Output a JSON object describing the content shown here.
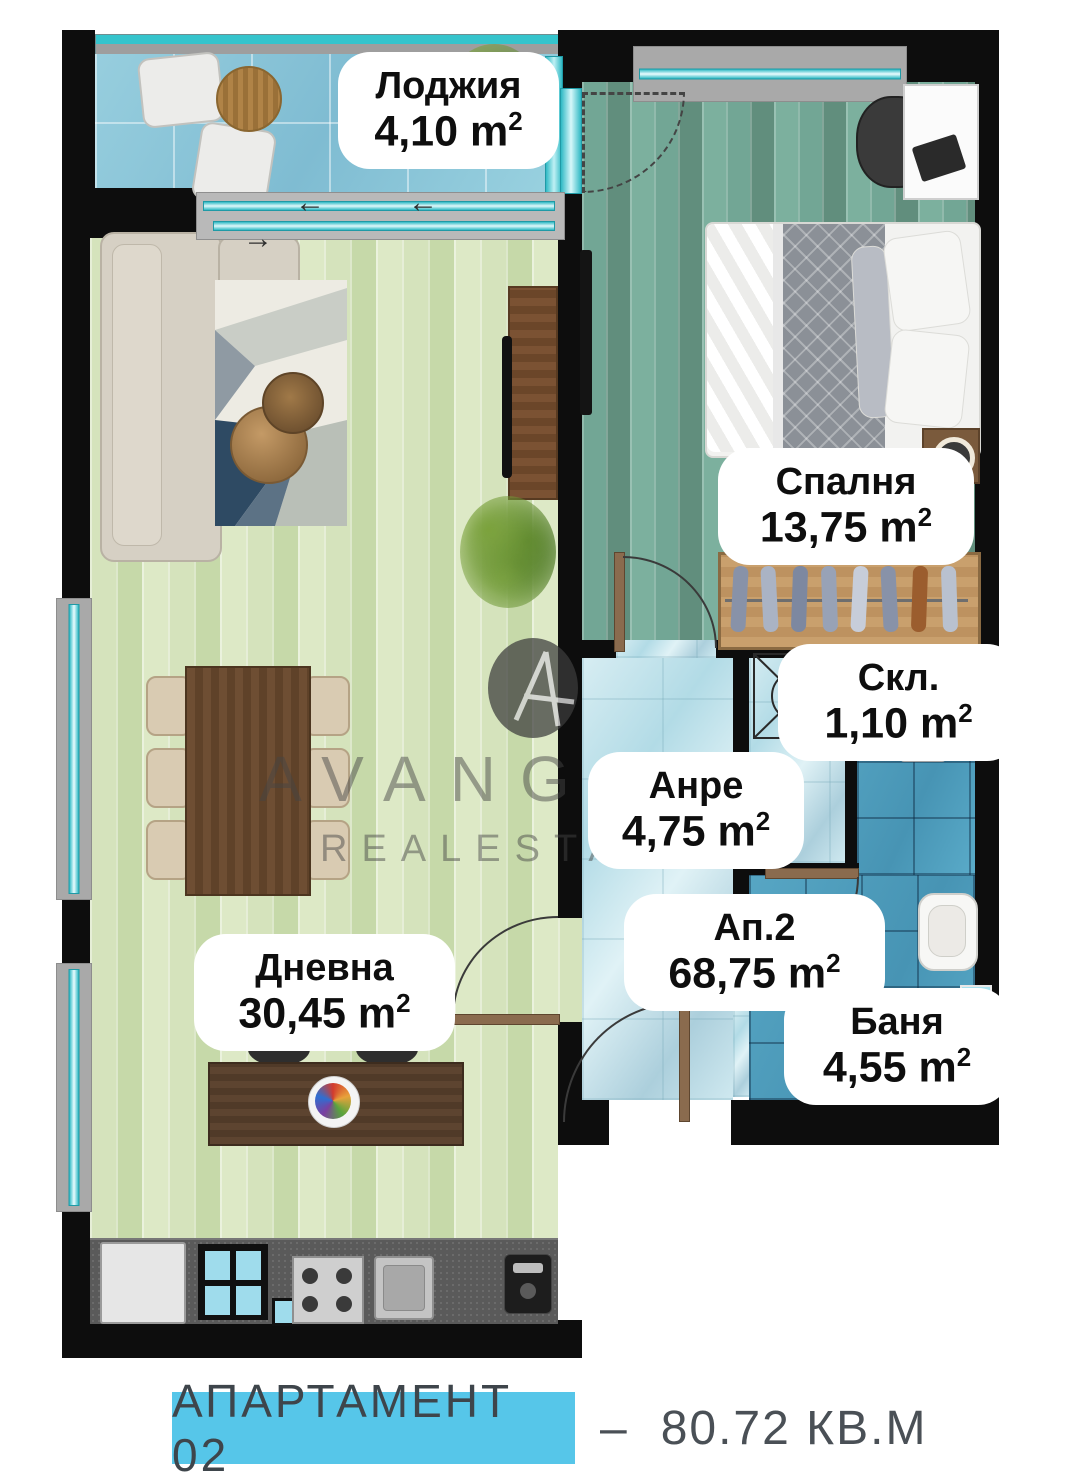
{
  "plan": {
    "rooms": [
      {
        "key": "loggia",
        "name": "Лоджия",
        "area": "4,10"
      },
      {
        "key": "bedroom",
        "name": "Спалня",
        "area": "13,75"
      },
      {
        "key": "living",
        "name": "Дневна",
        "area": "30,45"
      },
      {
        "key": "hall",
        "name": "Анре",
        "area": "4,75"
      },
      {
        "key": "storage",
        "name": "Скл.",
        "area": "1,10"
      },
      {
        "key": "bath",
        "name": "Баня",
        "area": "4,55"
      }
    ],
    "apartment": {
      "name": "Ап.2",
      "area": "68,75"
    },
    "unit": "m",
    "unit_sup": "2"
  },
  "arrows": {
    "left": "←",
    "right": "→"
  },
  "watermark": {
    "brand": "AVANGARD",
    "site": "REALESTATE.BG"
  },
  "footer": {
    "name": "АПАРТАМЕНТ 02",
    "dash": "–",
    "area": "80.72 КВ.М"
  },
  "colors": {
    "accent_cyan": "#56c6e9",
    "wall": "#0d0d0d",
    "window_glass": "#2fb9c4",
    "living_floor": "#cfdfb4",
    "bedroom_floor": "#6ea292",
    "loggia_floor": "#8ac4d8",
    "hall_floor": "#bfe2ea",
    "bath_tile": "#4d9dbd"
  }
}
